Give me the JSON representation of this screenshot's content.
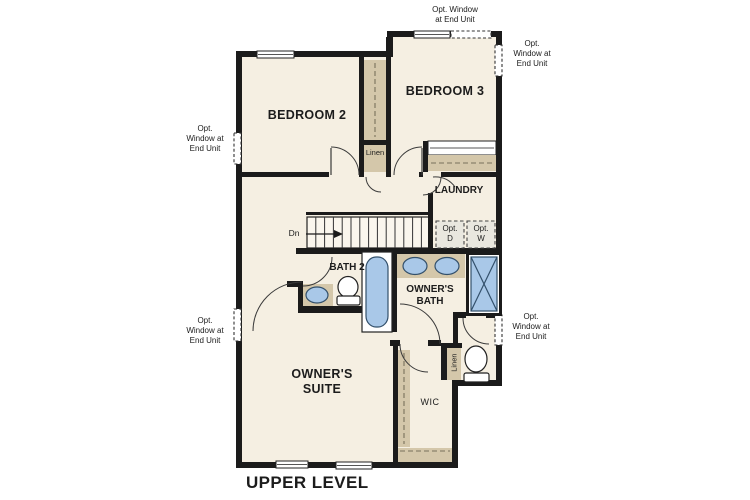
{
  "plan": {
    "title": "UPPER LEVEL",
    "rooms": {
      "bedroom2": "BEDROOM 2",
      "bedroom3": "BEDROOM 3",
      "laundry": "LAUNDRY",
      "bath2": "BATH 2",
      "owners_bath": "OWNER'S\nBATH",
      "owners_suite": "OWNER'S\nSUITE",
      "wic": "WIC"
    },
    "closets": {
      "linen_hall": "Linen",
      "linen_owners": "Linen"
    },
    "stairs": {
      "direction_label": "Dn"
    },
    "appliances": {
      "optional_dryer": "Opt.\nD",
      "optional_washer": "Opt.\nW"
    },
    "window_notes": {
      "top": "Opt. Window\nat End Unit",
      "right_upper": "Opt.\nWindow at\nEnd Unit",
      "left_upper": "Opt.\nWindow at\nEnd Unit",
      "left_lower": "Opt.\nWindow at\nEnd Unit",
      "right_lower": "Opt.\nWindow at\nEnd Unit"
    },
    "colors": {
      "wall": "#1b1b1b",
      "floor": "#f5efe2",
      "closet_tan": "#d4c7aa",
      "fixture_blue": "#a9c8e8",
      "stairs_fill": "#faf6ed",
      "appliance_box": "#e9e7df"
    }
  }
}
